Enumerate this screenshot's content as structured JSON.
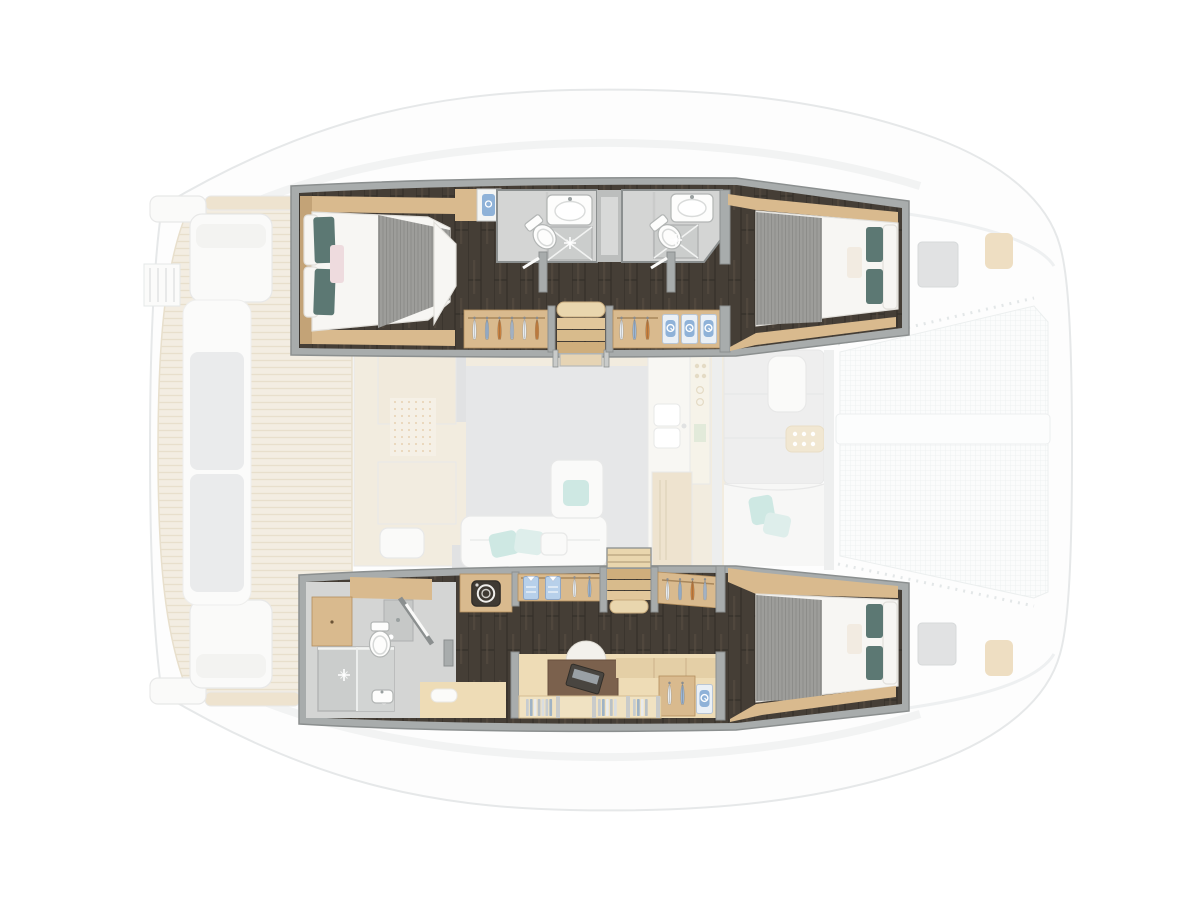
{
  "plan": {
    "vessel": "catamaran",
    "view": "overhead-deck-layout-plan",
    "bow_direction": "right",
    "highlighted_areas": [
      "port-hull-interior",
      "starboard-hull-interior"
    ],
    "ghosted_areas": [
      "aft-cockpit",
      "salon",
      "galley",
      "forward-cockpit",
      "foredeck",
      "trampoline",
      "swim-platforms"
    ]
  },
  "rooms": {
    "port_hull": {
      "aft_guest_cabin": {
        "bed": "double",
        "pillows": [
          "teal",
          "teal",
          "blush",
          "white"
        ],
        "floor": "dark-wood"
      },
      "aft_bathroom": {
        "fixtures": [
          "toilet",
          "sink",
          "shower"
        ]
      },
      "forward_bathroom": {
        "fixtures": [
          "toilet",
          "sink",
          "shower"
        ]
      },
      "wardrobe_aft": {
        "hangers": 6
      },
      "staircase": {
        "steps": 3
      },
      "wardrobe_forward": {
        "hangers": 3,
        "towel_cubbies": 3
      },
      "forward_guest_cabin": {
        "bed": "double",
        "pillows": [
          "teal",
          "teal",
          "cream",
          "white"
        ]
      }
    },
    "starboard_hull": {
      "owner_bathroom": {
        "fixtures": [
          "toilet",
          "vanity",
          "shower",
          "sink"
        ]
      },
      "laundry": {
        "appliance": "washing-machine"
      },
      "dressing": {
        "folded_shirts": 2,
        "hangers": 2
      },
      "staircase": {
        "steps": 3,
        "shelf_unit": true
      },
      "wardrobe_forward": {
        "hangers": 4
      },
      "office": {
        "desk": true,
        "chair": true,
        "laptop": true,
        "bookshelf_groups": 3,
        "closet_hangers": 2,
        "towel_cubbies": 1
      },
      "forward_owner_cabin": {
        "bed": "double",
        "pillows": [
          "teal",
          "teal",
          "cream",
          "white"
        ]
      }
    }
  },
  "colors": {
    "background": "#ffffff",
    "wall": "#a8acac",
    "wallEdge": "#8b8f8f",
    "wallLight": "#c9cbca",
    "floorDark": "#453e36",
    "floorDarkLine": "#342f29",
    "floorDarkHl": "#594f43",
    "wood": "#d9ba8e",
    "woodLight": "#e9d6ae",
    "woodDark": "#b28e5e",
    "deskFloor": "#eedcb6",
    "bathFloor": "#d4d5d4",
    "showerFloor": "#cbcdcc",
    "landing": "#bcbebd",
    "bedWhite": "#f7f6f3",
    "bedEdge": "#e2e0db",
    "runner": "#9d9d9a",
    "runnerLine": "#8b8b87",
    "teal": "#5c7873",
    "cream": "#f2ebe1",
    "blush": "#eedbde",
    "towelBlue": "#8fb2d8",
    "cubbyBg": "#eaf0f6",
    "cubbyEdge": "#bac6d4",
    "shirtBlue": "#b7d0ea",
    "washerBody": "#3f3a33",
    "deskBrown": "#7b614d",
    "laptop": "#494540",
    "ghostStroke": "#e2e5e6",
    "ghostTeak": "#f1ebdd",
    "ghostTeakLine": "#e4dac4",
    "ghostEdge": "#e4e5e4",
    "ghostWhite": "#fafaf9",
    "ghostBeige": "#f0e9da",
    "ghostWood": "#ecdfc7",
    "ghostGray": "#e7e8e9",
    "ghostGrayDark": "#dcdedf",
    "ghostTeal": "#c6e4df",
    "ghostTealLight": "#d9ece8",
    "meshLine": "#e9eded",
    "ghostDot": "#e6cfae"
  },
  "glyphs": {
    "hanger_palette": [
      "#e9edf0",
      "#9db6d2",
      "#c9813f",
      "#aebfd3",
      "#e9edf0",
      "#c9813f"
    ],
    "book_palette": [
      "#c6ccd0",
      "#9fb3c5",
      "#e9ebec",
      "#b9c1c6",
      "#d9dde0"
    ],
    "hangers": [
      {
        "x": 470,
        "y": 316,
        "count": 6,
        "gap": 12.5,
        "h": 26
      },
      {
        "x": 617,
        "y": 316,
        "count": 3,
        "gap": 13,
        "h": 26
      },
      {
        "x": 570,
        "y": 576,
        "count": 2,
        "gap": 15,
        "h": 23
      },
      {
        "x": 663,
        "y": 578,
        "count": 4,
        "gap": 12.5,
        "h": 24
      },
      {
        "x": 665,
        "y": 681,
        "count": 2,
        "gap": 13,
        "h": 26
      }
    ],
    "books": [
      {
        "x": 526,
        "y": 699,
        "count": 7,
        "gap": 3.9
      },
      {
        "x": 598,
        "y": 699,
        "count": 5,
        "gap": 4
      },
      {
        "x": 633,
        "y": 699,
        "count": 4,
        "gap": 4
      }
    ],
    "towel_cubbies": [
      {
        "x": 662,
        "y": 314
      },
      {
        "x": 681,
        "y": 314
      },
      {
        "x": 700,
        "y": 314
      },
      {
        "x": 696,
        "y": 684
      }
    ],
    "shirts": [
      {
        "x": 523,
        "y": 576
      },
      {
        "x": 545,
        "y": 576
      }
    ],
    "sparkles": [
      {
        "x": 563,
        "y": 236
      },
      {
        "x": 669,
        "y": 233
      },
      {
        "x": 337,
        "y": 668
      }
    ],
    "washers": [
      {
        "x": 471,
        "y": 580
      }
    ],
    "toilets": [
      {
        "x": 521,
        "y": 226,
        "rot": -38
      },
      {
        "x": 646,
        "y": 226,
        "rot": -38
      },
      {
        "x": 368,
        "y": 621,
        "rot": 0
      }
    ]
  }
}
